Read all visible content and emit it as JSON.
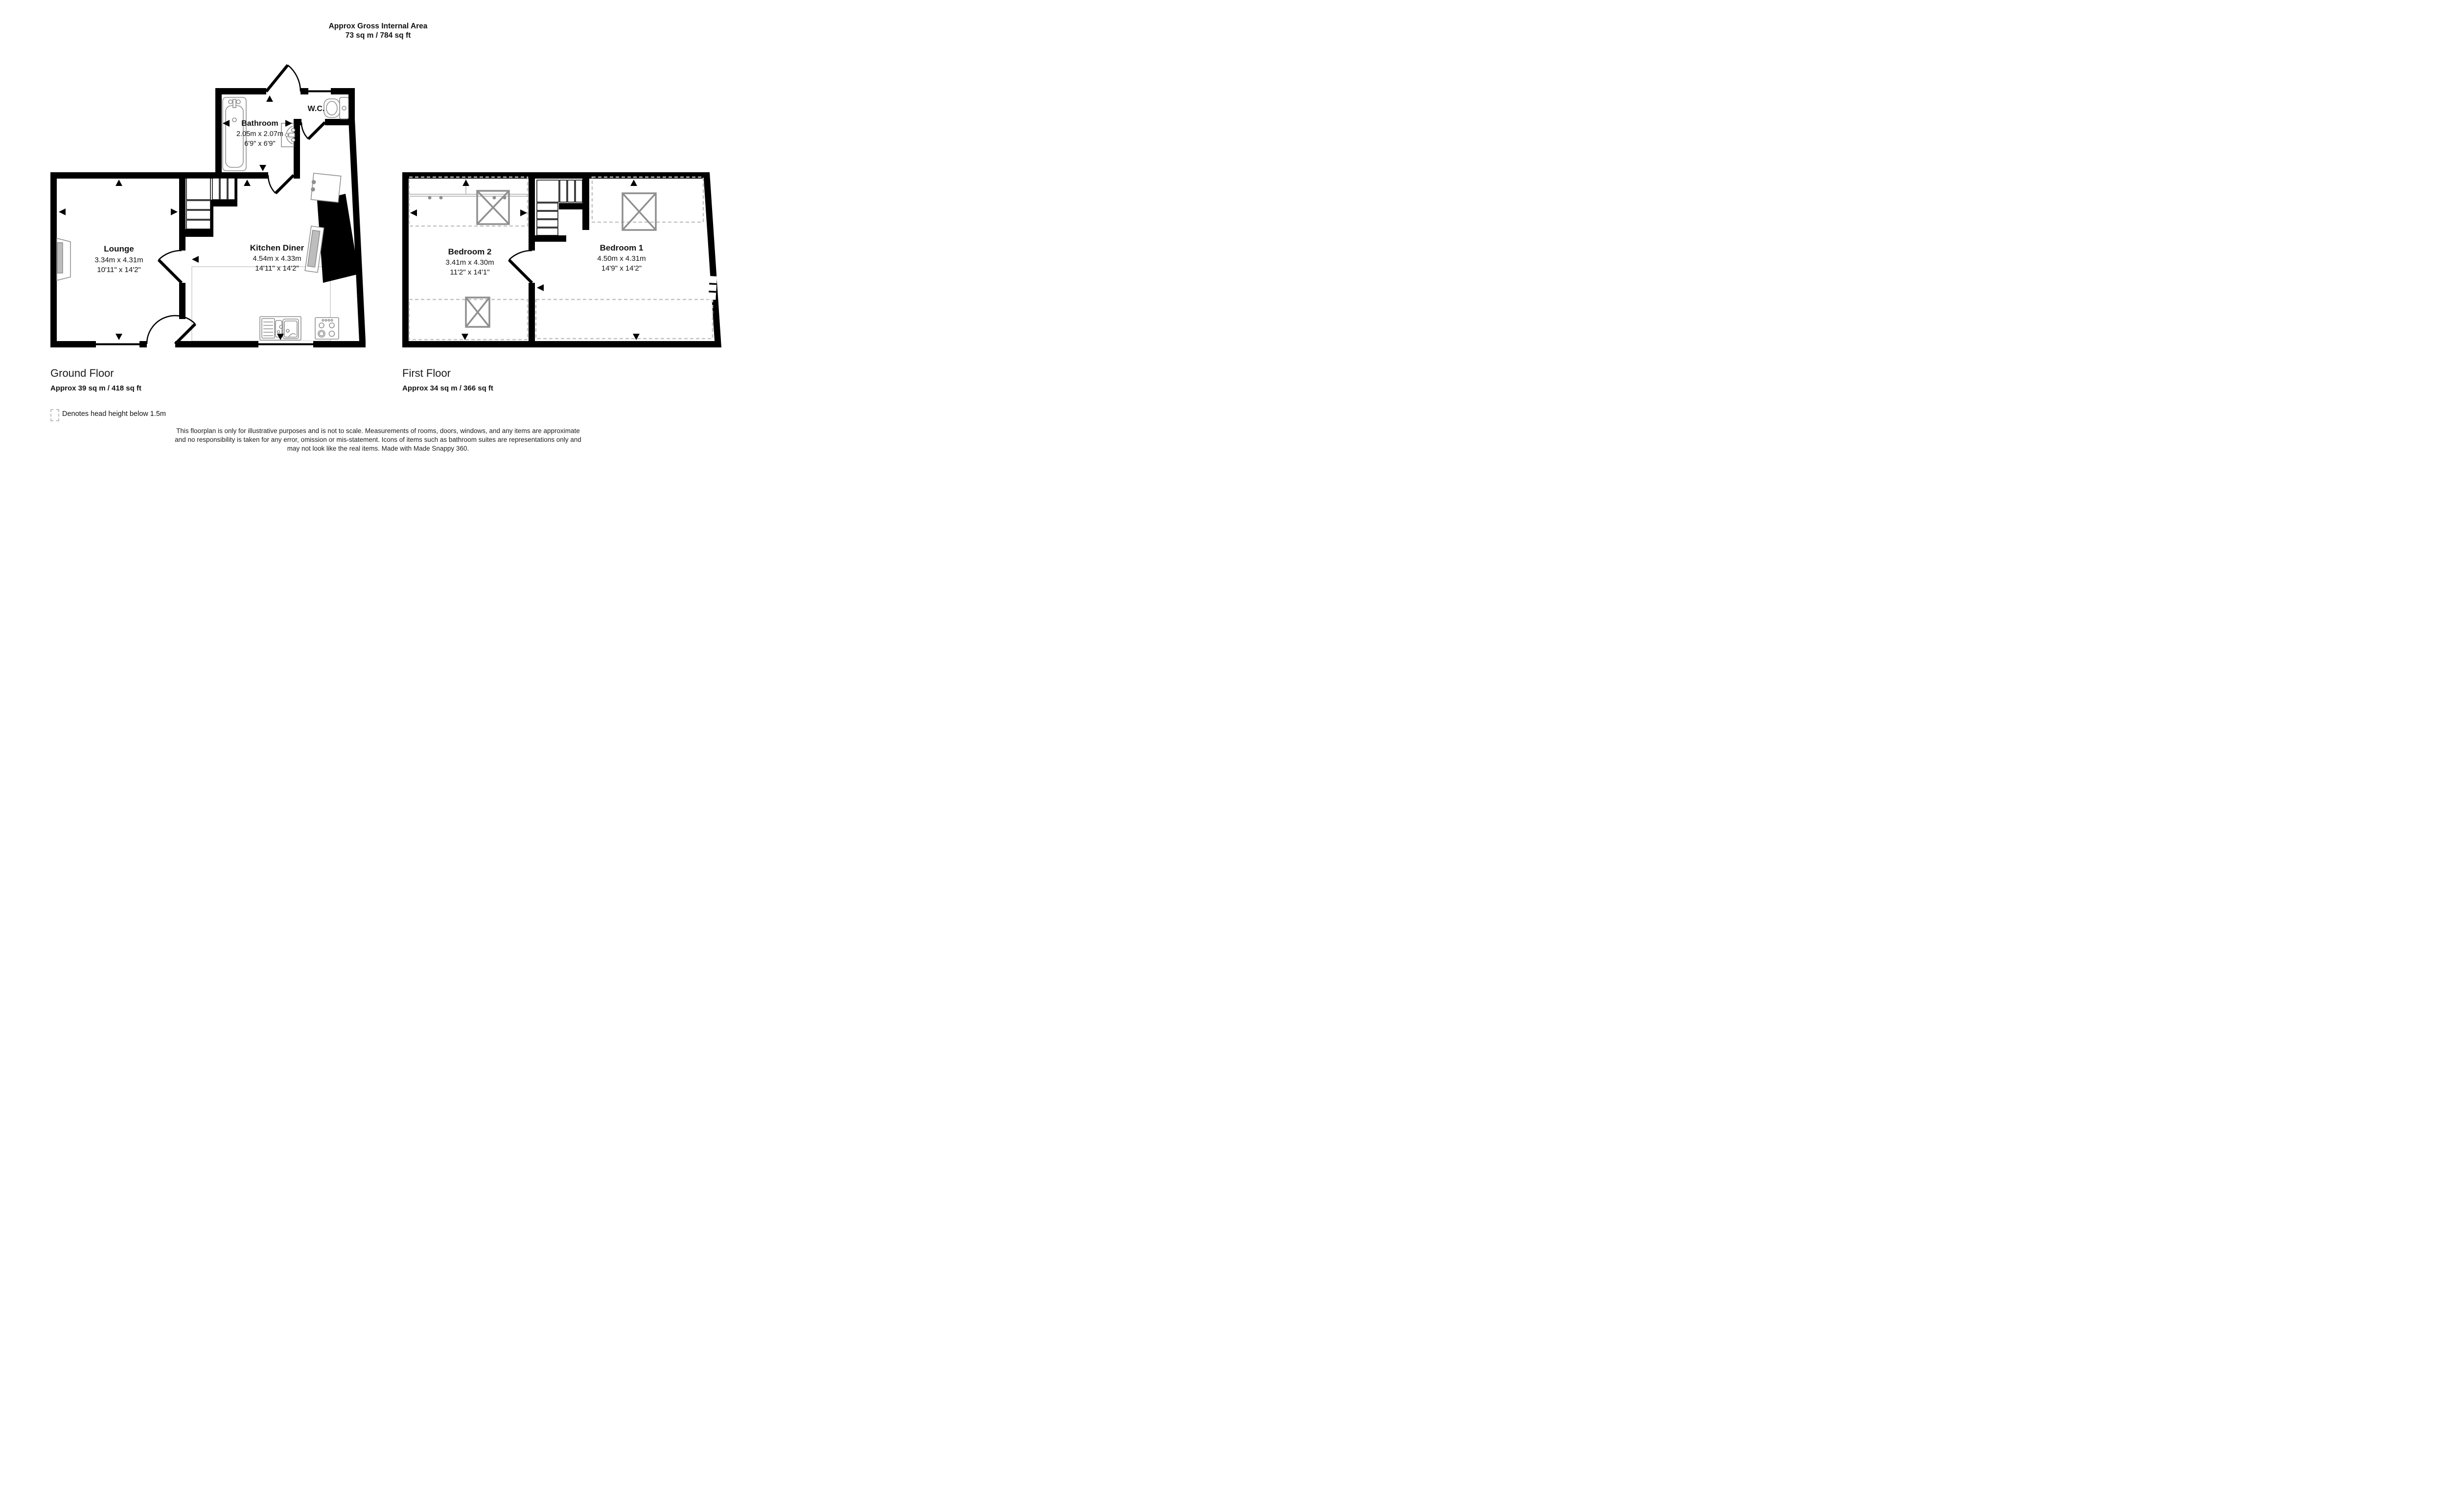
{
  "header": {
    "title_line1": "Approx Gross Internal Area",
    "title_line2": "73 sq m / 784 sq ft"
  },
  "ground_floor": {
    "label": "Ground Floor",
    "area": "Approx 39 sq m / 418 sq ft",
    "rooms": {
      "lounge": {
        "name": "Lounge",
        "size_metric": "3.34m x 4.31m",
        "size_imperial": "10'11\" x 14'2\""
      },
      "kitchen_diner": {
        "name": "Kitchen Diner",
        "size_metric": "4.54m x 4.33m",
        "size_imperial": "14'11\" x 14'2\""
      },
      "bathroom": {
        "name": "Bathroom",
        "size_metric": "2.05m x 2.07m",
        "size_imperial": "6'9\" x 6'9\""
      },
      "wc": {
        "name": "W.C."
      }
    }
  },
  "first_floor": {
    "label": "First Floor",
    "area": "Approx 34 sq m / 366 sq ft",
    "rooms": {
      "bedroom2": {
        "name": "Bedroom 2",
        "size_metric": "3.41m x 4.30m",
        "size_imperial": "11'2\" x 14'1\""
      },
      "bedroom1": {
        "name": "Bedroom 1",
        "size_metric": "4.50m x 4.31m",
        "size_imperial": "14'9\" x 14'2\""
      }
    }
  },
  "legend": {
    "text": "Denotes head height below 1.5m"
  },
  "disclaimer": {
    "line1": "This floorplan is only for illustrative purposes and is not to scale. Measurements of rooms, doors, windows, and any items are approximate",
    "line2": "and no responsibility is taken for any error, omission or mis-statement. Icons of items such as bathroom suites are representations only and",
    "line3": "may not look like the real items. Made with Made Snappy 360."
  },
  "colors": {
    "wall": "#000000",
    "fixture": "#8f8f8f",
    "head_height_dash": "#c3c3c3",
    "text": "#111111",
    "background": "#ffffff"
  }
}
